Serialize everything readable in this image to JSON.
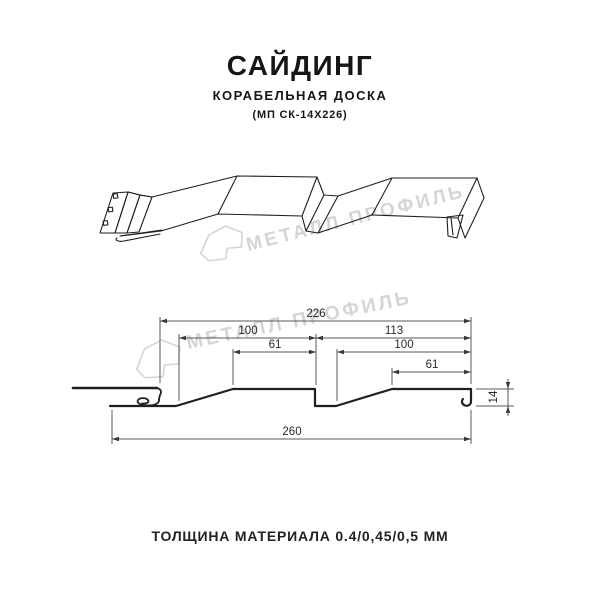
{
  "header": {
    "title": "САЙДИНГ",
    "subtitle": "КОРАБЕЛЬНАЯ ДОСКА",
    "model": "(МП СК-14Х226)"
  },
  "watermark": {
    "brand": "МЕТАЛЛ ПРОФИЛЬ",
    "color": "#d5d5d5"
  },
  "diagram": {
    "dimensions": {
      "module_width": "226",
      "left_panel": "100",
      "right_panel": "113",
      "left_flat": "61",
      "right_inner": "100",
      "right_flat": "61",
      "overall_width": "260",
      "profile_height": "14"
    },
    "colors": {
      "profile_line": "#1f1f1f",
      "dimension_line": "#5a5a5a"
    }
  },
  "footer": {
    "thickness_note": "ТОЛЩИНА МАТЕРИАЛА 0.4/0,45/0,5 ММ"
  }
}
